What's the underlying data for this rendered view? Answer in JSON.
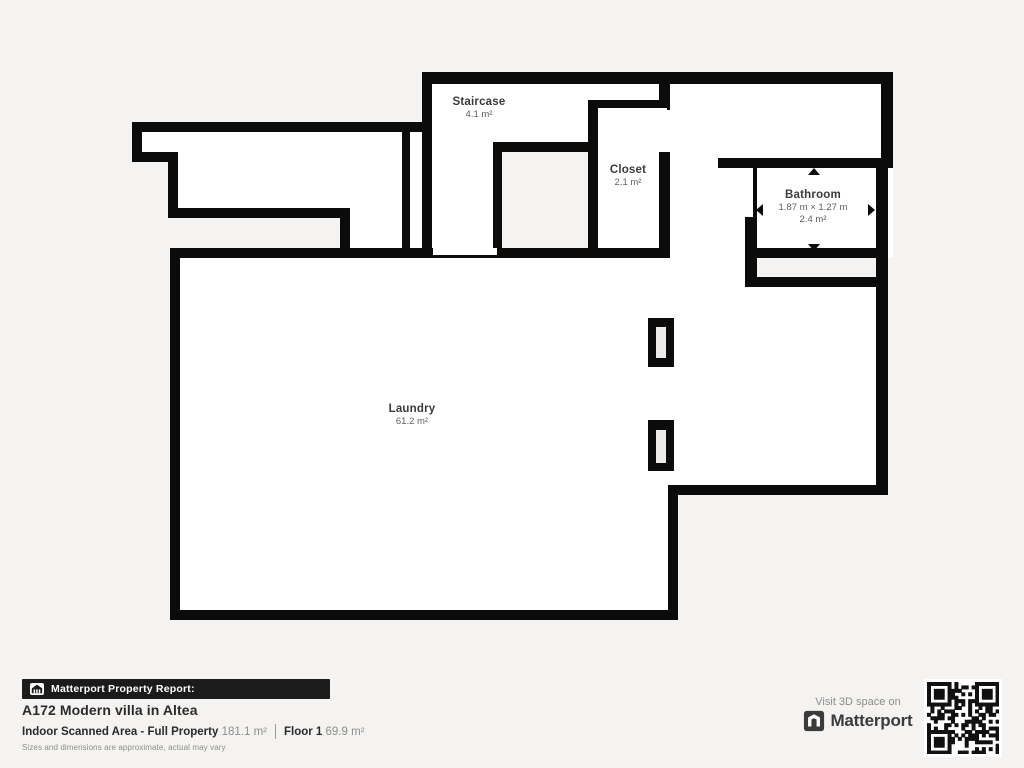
{
  "page": {
    "background": "#f4f3f1"
  },
  "floorplan": {
    "rooms": {
      "staircase": {
        "name": "Staircase",
        "area": "4.1 m²"
      },
      "closet": {
        "name": "Closet",
        "area": "2.1 m²"
      },
      "bathroom": {
        "name": "Bathroom",
        "dimensions": "1.87 m × 1.27 m",
        "area": "2.4 m²"
      },
      "laundry": {
        "name": "Laundry",
        "area": "61.2 m²"
      }
    }
  },
  "footer": {
    "badge_label": "Matterport Property Report:",
    "property_title": "A172 Modern villa in Altea",
    "scanned_area_label": "Indoor Scanned Area - Full Property",
    "scanned_area_value": "181.1 m²",
    "floor_label": "Floor 1",
    "floor_value": "69.9 m²",
    "disclaimer": "Sizes and dimensions are approximate, actual may vary"
  },
  "cta": {
    "visit_label": "Visit 3D space on",
    "brand_name": "Matterport"
  },
  "colors": {
    "wall": "#0b0b0b",
    "floor": "#ffffff",
    "background": "#f4f3f1",
    "banner_bg": "#1b1b1b",
    "text_dark": "#2b2b2b",
    "text_gray": "#8d8d8d"
  }
}
